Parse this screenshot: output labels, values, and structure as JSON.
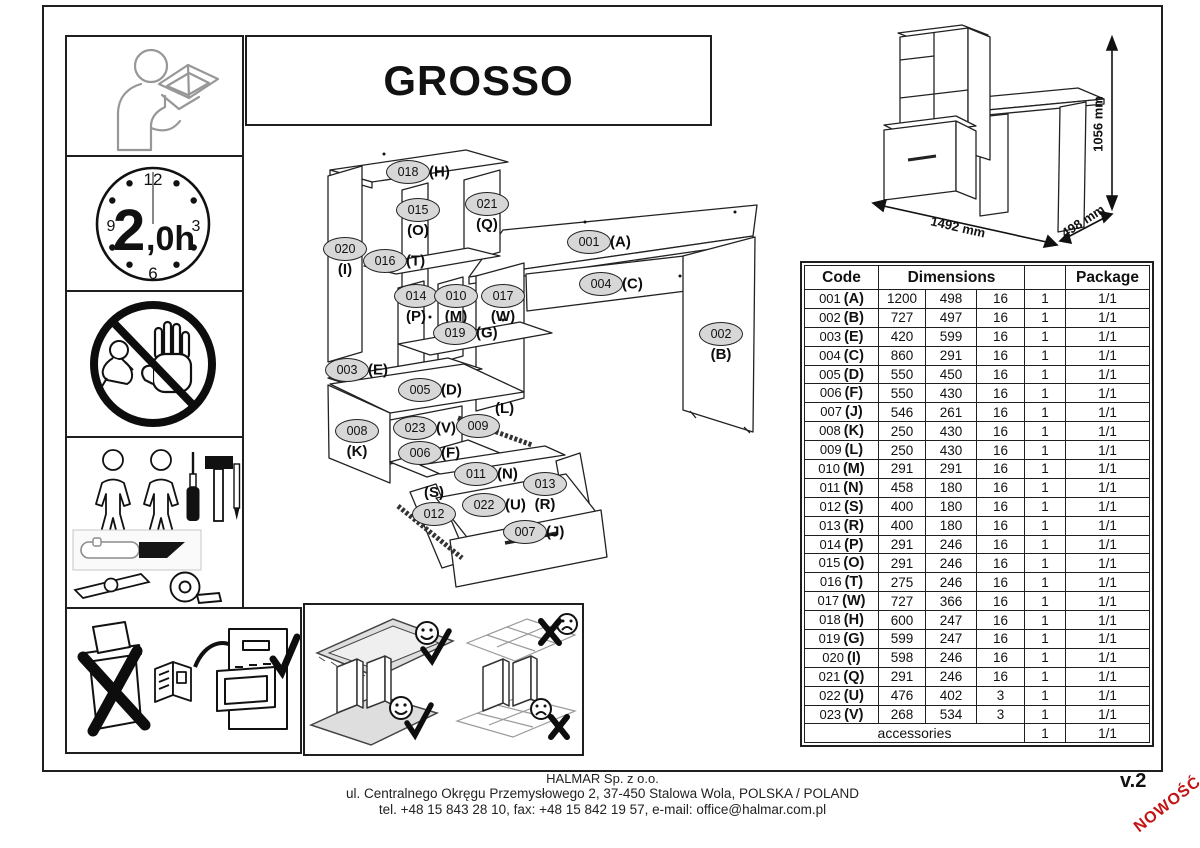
{
  "page": {
    "title": "GROSSO",
    "version": "v.2",
    "new_badge": "NOWOŚĆ"
  },
  "colors": {
    "accent_red": "#c41414",
    "callout_fill": "#d7d7d7",
    "line": "#222222"
  },
  "icons": {
    "read_manual": "person-reading-manual-icon",
    "clock": {
      "name": "assembly-time-clock-icon",
      "big": "2",
      "small": ",0h",
      "top": "12",
      "right": "3",
      "bottom": "6",
      "left": "9"
    },
    "no_children": "keep-children-away-icon",
    "tools": "two-people-and-tools-icon",
    "disposal": "keep-manual-do-not-discard-icon",
    "carpet": "assemble-on-soft-surface-icon"
  },
  "assembled_view": {
    "dimensions": [
      {
        "label": "1492 mm",
        "x": 958,
        "y": 227,
        "rot": 13
      },
      {
        "label": "498 mm",
        "x": 1083,
        "y": 221,
        "rot": -33
      },
      {
        "label": "1056 mm",
        "x": 1098,
        "y": 124,
        "rot": -90
      }
    ]
  },
  "diagram": {
    "callouts": [
      {
        "code": "018",
        "letter": "(H)",
        "x": 408,
        "y": 172,
        "pos": "right"
      },
      {
        "code": "015",
        "letter": "(O)",
        "x": 418,
        "y": 210,
        "pos": "below"
      },
      {
        "code": "021",
        "letter": "(Q)",
        "x": 487,
        "y": 204,
        "pos": "below"
      },
      {
        "code": "020",
        "letter": "(I)",
        "x": 345,
        "y": 249,
        "pos": "below"
      },
      {
        "code": "016",
        "letter": "(T)",
        "x": 385,
        "y": 261,
        "pos": "right"
      },
      {
        "code": "001",
        "letter": "(A)",
        "x": 589,
        "y": 242,
        "pos": "right"
      },
      {
        "code": "004",
        "letter": "(C)",
        "x": 601,
        "y": 284,
        "pos": "right"
      },
      {
        "code": "014",
        "letter": "(P)",
        "x": 416,
        "y": 296,
        "pos": "below"
      },
      {
        "code": "010",
        "letter": "(M)",
        "x": 456,
        "y": 296,
        "pos": "below"
      },
      {
        "code": "017",
        "letter": "(W)",
        "x": 503,
        "y": 296,
        "pos": "below"
      },
      {
        "code": "019",
        "letter": "(G)",
        "x": 455,
        "y": 333,
        "pos": "right"
      },
      {
        "code": "002",
        "letter": "(B)",
        "x": 721,
        "y": 334,
        "pos": "below"
      },
      {
        "code": "003",
        "letter": "(E)",
        "x": 347,
        "y": 370,
        "pos": "right"
      },
      {
        "code": "005",
        "letter": "(D)",
        "x": 420,
        "y": 390,
        "pos": "right"
      },
      {
        "code": "008",
        "letter": "(K)",
        "x": 357,
        "y": 431,
        "pos": "below"
      },
      {
        "code": "023",
        "letter": "(V)",
        "x": 415,
        "y": 428,
        "pos": "right"
      },
      {
        "code": "009",
        "letter": "(L)",
        "x": 478,
        "y": 426,
        "pos": "above-right"
      },
      {
        "code": "006",
        "letter": "(F)",
        "x": 420,
        "y": 453,
        "pos": "right"
      },
      {
        "code": "011",
        "letter": "(N)",
        "x": 476,
        "y": 474,
        "pos": "right"
      },
      {
        "code": "013",
        "letter": "(R)",
        "x": 545,
        "y": 484,
        "pos": "below"
      },
      {
        "code": "012",
        "letter": "(S)",
        "x": 434,
        "y": 514,
        "pos": "above"
      },
      {
        "code": "022",
        "letter": "(U)",
        "x": 484,
        "y": 505,
        "pos": "right"
      },
      {
        "code": "007",
        "letter": "(J)",
        "x": 525,
        "y": 532,
        "pos": "right"
      }
    ]
  },
  "table": {
    "header_code": "Code",
    "header_dimensions": "Dimensions",
    "header_package": "Package",
    "rows": [
      [
        "001",
        "(A)",
        "1200",
        "498",
        "16",
        "1",
        "1/1"
      ],
      [
        "002",
        "(B)",
        "727",
        "497",
        "16",
        "1",
        "1/1"
      ],
      [
        "003",
        "(E)",
        "420",
        "599",
        "16",
        "1",
        "1/1"
      ],
      [
        "004",
        "(C)",
        "860",
        "291",
        "16",
        "1",
        "1/1"
      ],
      [
        "005",
        "(D)",
        "550",
        "450",
        "16",
        "1",
        "1/1"
      ],
      [
        "006",
        "(F)",
        "550",
        "430",
        "16",
        "1",
        "1/1"
      ],
      [
        "007",
        "(J)",
        "546",
        "261",
        "16",
        "1",
        "1/1"
      ],
      [
        "008",
        "(K)",
        "250",
        "430",
        "16",
        "1",
        "1/1"
      ],
      [
        "009",
        "(L)",
        "250",
        "430",
        "16",
        "1",
        "1/1"
      ],
      [
        "010",
        "(M)",
        "291",
        "291",
        "16",
        "1",
        "1/1"
      ],
      [
        "011",
        "(N)",
        "458",
        "180",
        "16",
        "1",
        "1/1"
      ],
      [
        "012",
        "(S)",
        "400",
        "180",
        "16",
        "1",
        "1/1"
      ],
      [
        "013",
        "(R)",
        "400",
        "180",
        "16",
        "1",
        "1/1"
      ],
      [
        "014",
        "(P)",
        "291",
        "246",
        "16",
        "1",
        "1/1"
      ],
      [
        "015",
        "(O)",
        "291",
        "246",
        "16",
        "1",
        "1/1"
      ],
      [
        "016",
        "(T)",
        "275",
        "246",
        "16",
        "1",
        "1/1"
      ],
      [
        "017",
        "(W)",
        "727",
        "366",
        "16",
        "1",
        "1/1"
      ],
      [
        "018",
        "(H)",
        "600",
        "247",
        "16",
        "1",
        "1/1"
      ],
      [
        "019",
        "(G)",
        "599",
        "247",
        "16",
        "1",
        "1/1"
      ],
      [
        "020",
        "(I)",
        "598",
        "246",
        "16",
        "1",
        "1/1"
      ],
      [
        "021",
        "(Q)",
        "291",
        "246",
        "16",
        "1",
        "1/1"
      ],
      [
        "022",
        "(U)",
        "476",
        "402",
        "3",
        "1",
        "1/1"
      ],
      [
        "023",
        "(V)",
        "268",
        "534",
        "3",
        "1",
        "1/1"
      ]
    ],
    "accessories": {
      "label": "accessories",
      "qty": "1",
      "pkg": "1/1"
    }
  },
  "footer": {
    "company": "HALMAR Sp. z o.o.",
    "address": "ul. Centralnego Okręgu Przemysłowego 2, 37-450 Stalowa Wola, POLSKA / POLAND",
    "contact": "tel. +48 15 843 28 10, fax: +48 15 842 19 57, e-mail: office@halmar.com.pl"
  }
}
